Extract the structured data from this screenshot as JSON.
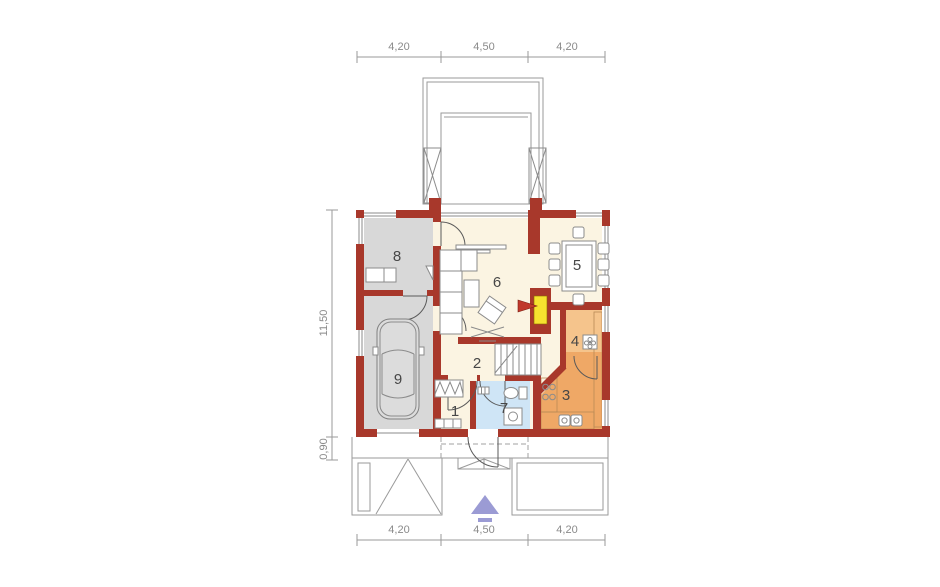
{
  "dimensions": {
    "top": [
      "4,20",
      "4,50",
      "4,20"
    ],
    "bottom": [
      "4,20",
      "4,50",
      "4,20"
    ],
    "left_total": "11,50",
    "left_front": "0,90"
  },
  "rooms": [
    {
      "number": "1"
    },
    {
      "number": "2"
    },
    {
      "number": "3"
    },
    {
      "number": "4"
    },
    {
      "number": "5"
    },
    {
      "number": "6"
    },
    {
      "number": "7"
    },
    {
      "number": "8"
    },
    {
      "number": "9"
    }
  ],
  "colors": {
    "wall": "#a8382b",
    "floor_main": "#fbf4e2",
    "floor_garage": "#d8d8d8",
    "floor_kitchen": "#efa866",
    "floor_pantry": "#f5c48c",
    "counter": "#f8d2a4",
    "floor_wc": "#cfe5f6",
    "fireplace_yellow": "#f6e22f",
    "fireplace_arrow": "#c0392b",
    "entrance_arrow": "#9b9bd4",
    "car_body": "#dcdcdc"
  }
}
